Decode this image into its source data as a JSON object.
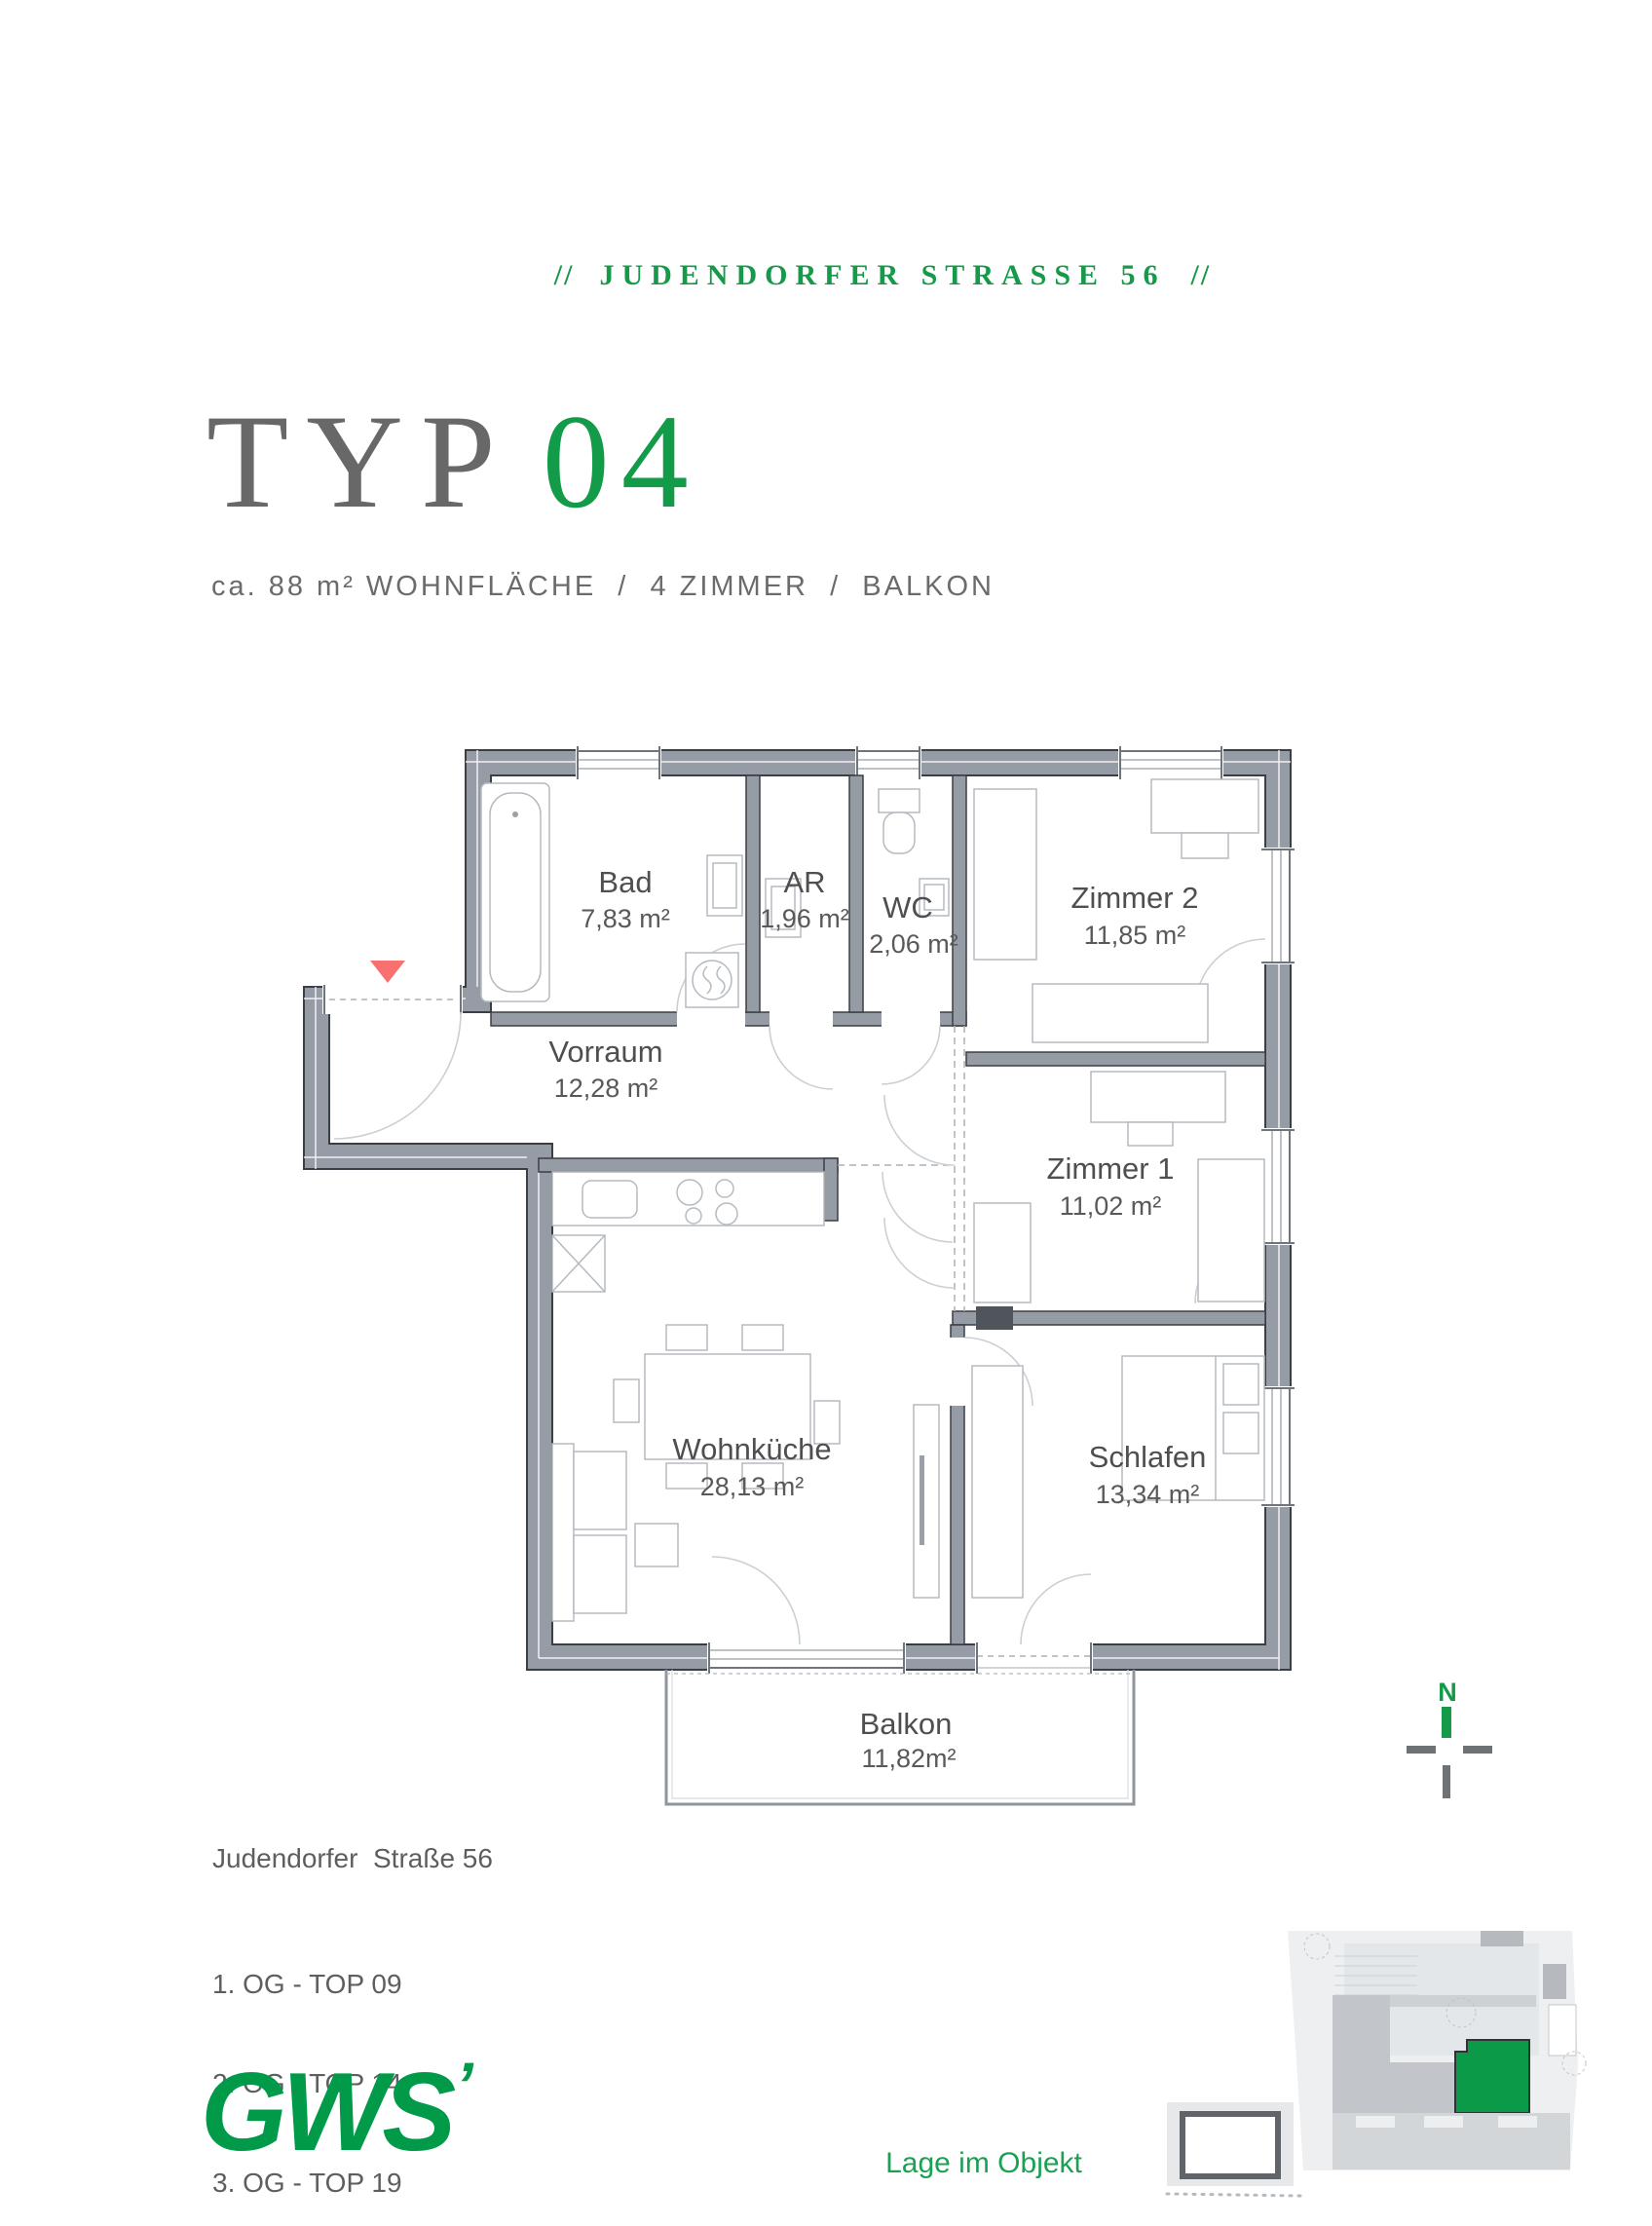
{
  "header": {
    "slash_left": "//",
    "street": "JUDENDORFER STRASSE 56",
    "slash_right": "//",
    "color": "#17994a"
  },
  "title": {
    "prefix": "TYP",
    "number": "04",
    "prefix_color": "#686868",
    "number_color": "#129b49"
  },
  "subtitle": "ca. 88 m² WOHNFLÄCHE  /  4 ZIMMER  /  BALKON",
  "floorplan": {
    "rooms": [
      {
        "id": "bad",
        "name": "Bad",
        "area": "7,83 m²"
      },
      {
        "id": "ar",
        "name": "AR",
        "area": "1,96 m²"
      },
      {
        "id": "wc",
        "name": "WC",
        "area": "2,06 m²"
      },
      {
        "id": "zimmer2",
        "name": "Zimmer 2",
        "area": "11,85 m²"
      },
      {
        "id": "vorraum",
        "name": "Vorraum",
        "area": "12,28 m²"
      },
      {
        "id": "zimmer1",
        "name": "Zimmer 1",
        "area": "11,02 m²"
      },
      {
        "id": "wohnkueche",
        "name": "Wohnküche",
        "area": "28,13 m²"
      },
      {
        "id": "schlafen",
        "name": "Schlafen",
        "area": "13,34 m²"
      },
      {
        "id": "balkon",
        "name": "Balkon",
        "area": "11,82m²"
      }
    ],
    "wall_color": "#969ca5",
    "entrance_marker_color": "#f97070"
  },
  "compass": {
    "label": "N",
    "color": "#149a48"
  },
  "footer": {
    "address": "Judendorfer  Straße 56",
    "units": [
      "1. OG - TOP 09",
      "2. OG - TOP 14",
      "3. OG - TOP 19"
    ]
  },
  "logo": {
    "text": "GWS",
    "mark": "’",
    "color": "#009a49"
  },
  "siteplan": {
    "caption": "Lage im Objekt",
    "highlight_color": "#0b9a47"
  }
}
